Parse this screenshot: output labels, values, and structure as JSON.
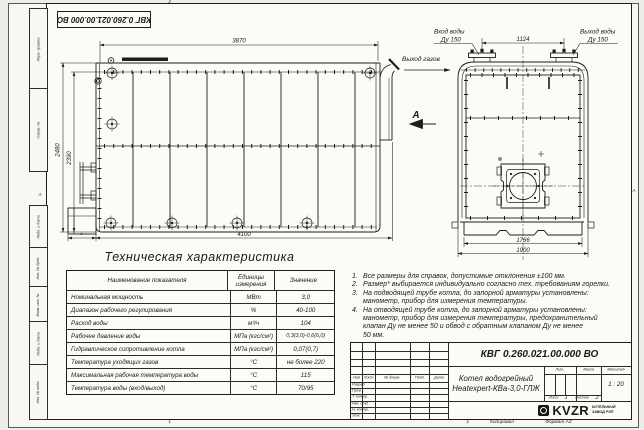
{
  "doc": {
    "number": "КВГ 0.260.021.00.000 ВО",
    "title_line1": "Котел водогрейный",
    "title_line2": "Heatexpert-КВа-3,0-ГЛЖ",
    "scale": "1 : 20",
    "sheet": "1",
    "sheets": "2",
    "copied": "Копировал",
    "format": "Формат А3",
    "logo": "KVZR",
    "logo_sub1": "КОТЕЛЬНЫЙ",
    "logo_sub2": "ЗАВОД РЭП"
  },
  "frame": {
    "left_labels": [
      "Перв. примен.",
      "Справ. №",
      "Подп. и дата",
      "Инв. № дубл.",
      "Взам. инв. №",
      "Подп. и дата",
      "Инв. № подл."
    ],
    "stamp_header": [
      "Изм",
      "Лист",
      "№ докум.",
      "Подп.",
      "Дата"
    ],
    "stamp_rows": [
      "Разраб.",
      "Пров.",
      "Т. контр.",
      "Нач. отд.",
      "Н. контр.",
      "Утв."
    ],
    "lit_label": "Лит.",
    "mass_label": "Масса",
    "scale_label": "Масштаб",
    "sheet_label": "Лист",
    "sheets_label": "Листов",
    "zone_top": "2",
    "zone_bottom": "1",
    "zone_left": "А",
    "zone_right": "А",
    "copied_zone": "1"
  },
  "views": {
    "side": {
      "dim_top": "3870",
      "dim_left_outer": "2480",
      "dim_left_inner": "2390",
      "dim_bottom": "4100",
      "dim_star": "*",
      "gas_outlet_label": "Выход газов",
      "view_arrow_label": "А"
    },
    "front": {
      "inlet_label1": "Вход воды",
      "inlet_label2": "Ду 150",
      "outlet_label1": "Выход воды",
      "outlet_label2": "Ду 150",
      "dim_flanges": "1124",
      "dim_inner": "1766",
      "dim_outer": "1900"
    }
  },
  "table": {
    "title": "Техническая характеристика",
    "headers": [
      "Наименование показателя",
      "Единицы измерения",
      "Значение"
    ],
    "rows": [
      [
        "Номинальная мощность",
        "МВт",
        "3,0"
      ],
      [
        "Диапазон рабочего регулирования",
        "%",
        "40-100"
      ],
      [
        "Расход воды",
        "м³/ч",
        "104"
      ],
      [
        "Рабочее давление воды",
        "МПа (кгс/см²)",
        "0,3(3,0)-0,6(6,0)"
      ],
      [
        "Гидравлическое сопротивление котла",
        "МПа (кгс/см²)",
        "0,07(0,7)"
      ],
      [
        "Температура уходящих газов",
        "°С",
        "не более 220"
      ],
      [
        "Максимальная рабочая температура воды",
        "°С",
        "115"
      ],
      [
        "Температура воды (вход/выход)",
        "°С",
        "70/95"
      ]
    ]
  },
  "notes": [
    {
      "num": "1.",
      "text": "Все размеры для справок, допустимые отклонения ±100 мм."
    },
    {
      "num": "2.",
      "text": "Размер* выбирается индивидуально согласно тех. требованиям горелки."
    },
    {
      "num": "3.",
      "text": "На подводящей трубе котла, до запорной арматуры установлены:\nманометр, прибор для измерения температуры."
    },
    {
      "num": "4.",
      "text": "На отводящей трубе котла, до запорной арматуры установлены:\nманометр, прибор для измерения температуры, предохранительный\nклапан Ду не менее 50 и обвод с обратным клапаном Ду не менее\n50 мм."
    }
  ]
}
